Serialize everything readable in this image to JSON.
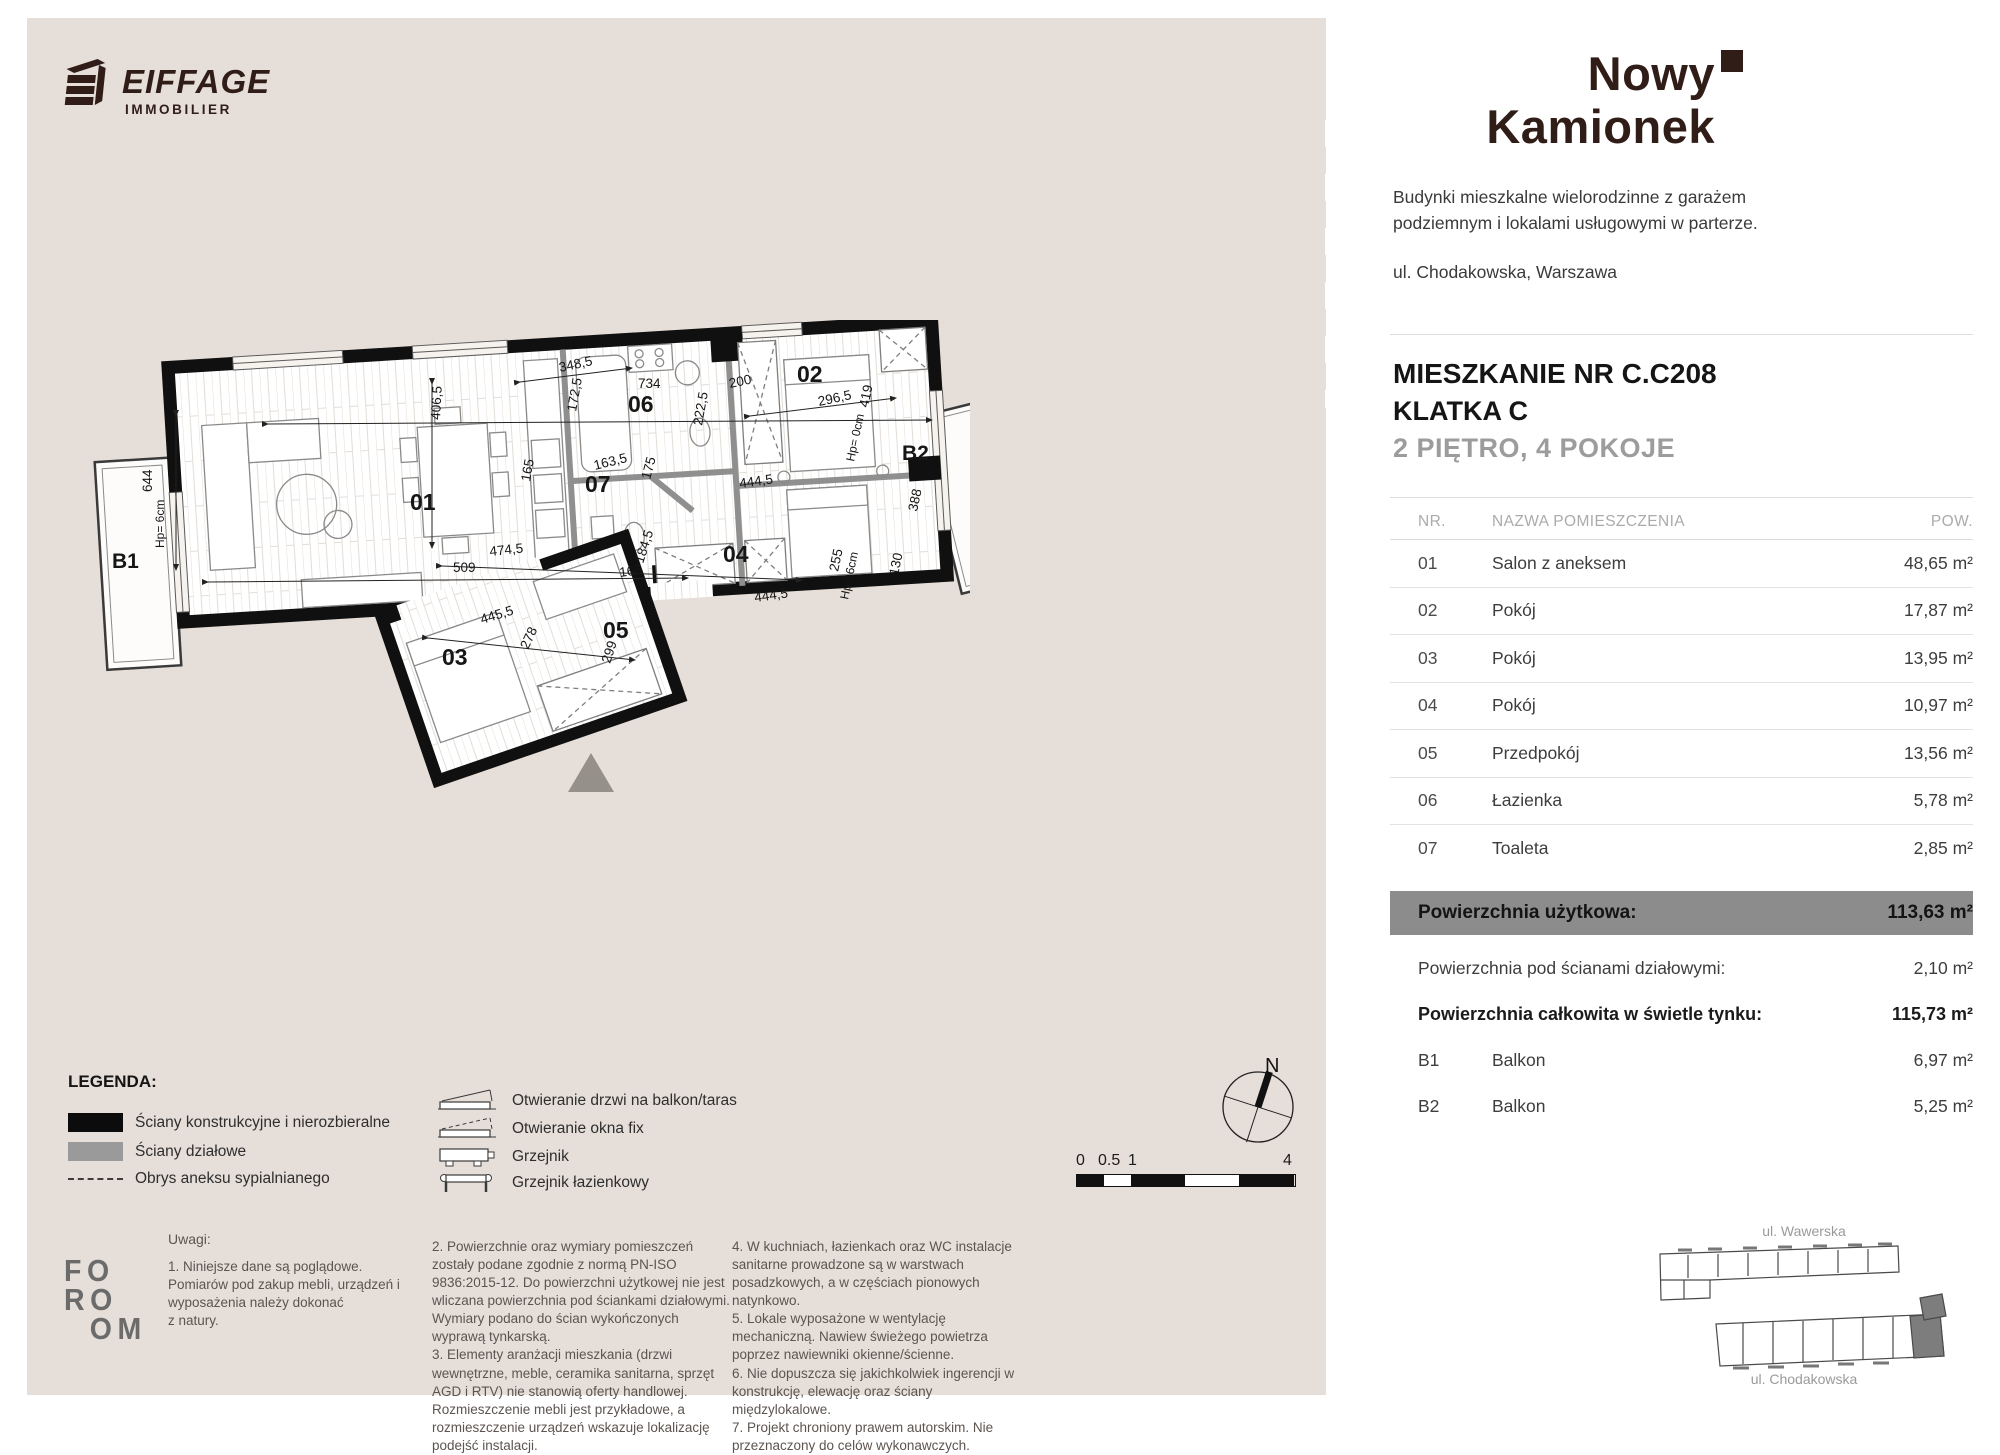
{
  "brand": {
    "logo_text": "EIFFAGE",
    "logo_sub": "IMMOBILIER"
  },
  "project": {
    "title_line1": "Nowy",
    "title_line2": "Kamionek",
    "description": "Budynki mieszkalne wielorodzinne z garażem podziemnym i lokalami usługowymi w parterze.",
    "address": "ul. Chodakowska, Warszawa"
  },
  "apartment": {
    "name": "MIESZKANIE NR C.C208",
    "staircase": "KLATKA C",
    "floor_rooms": "2 PIĘTRO, 4 POKOJE"
  },
  "table": {
    "headers": {
      "nr": "NR.",
      "name": "NAZWA POMIESZCZENIA",
      "area": "POW."
    },
    "rows": [
      {
        "nr": "01",
        "name": "Salon z aneksem",
        "area": "48,65 m²"
      },
      {
        "nr": "02",
        "name": "Pokój",
        "area": "17,87 m²"
      },
      {
        "nr": "03",
        "name": "Pokój",
        "area": "13,95 m²"
      },
      {
        "nr": "04",
        "name": "Pokój",
        "area": "10,97 m²"
      },
      {
        "nr": "05",
        "name": "Przedpokój",
        "area": "13,56 m²"
      },
      {
        "nr": "06",
        "name": "Łazienka",
        "area": "5,78 m²"
      },
      {
        "nr": "07",
        "name": "Toaleta",
        "area": "2,85 m²"
      }
    ],
    "summary_highlight": {
      "label": "Powierzchnia użytkowa:",
      "value": "113,63 m²"
    },
    "summary_rows": [
      {
        "label": "Powierzchnia pod ścianami działowymi:",
        "value": "2,10 m²"
      },
      {
        "label": "Powierzchnia całkowita w świetle tynku:",
        "value": "115,73 m²"
      }
    ],
    "balconies": [
      {
        "nr": "B1",
        "name": "Balkon",
        "area": "6,97 m²"
      },
      {
        "nr": "B2",
        "name": "Balkon",
        "area": "5,25 m²"
      }
    ]
  },
  "legend": {
    "title": "LEGENDA:",
    "items_left": [
      "Ściany konstrukcyjne i nierozbieralne",
      "Ściany działowe",
      "Obrys aneksu sypialnianego"
    ],
    "items_right": [
      "Otwieranie drzwi na balkon/taras",
      "Otwieranie okna fix",
      "Grzejnik",
      "Grzejnik łazienkowy"
    ]
  },
  "notes": {
    "title": "Uwagi:",
    "col1": "1. Niniejsze dane są poglądowe.\n Pomiarów pod zakup mebli, urządzeń i wyposażenia należy dokonać\nz natury.",
    "col2": "2. Powierzchnie oraz wymiary pomieszczeń zostały podane zgodnie z normą PN-ISO 9836:2015-12. Do powierzchni użytkowej nie jest wliczana powierzchnia pod ściankami działowymi. Wymiary podano do ścian wykończonych wyprawą tynkarską.\n3. Elementy aranżacji mieszkania (drzwi wewnętrzne, meble, ceramika sanitarna, sprzęt AGD i RTV) nie stanowią oferty handlowej. Rozmieszczenie mebli jest przykładowe, a rozmieszczenie urządzeń wskazuje lokalizację podejść instalacji.",
    "col3": "4. W kuchniach, łazienkach oraz WC instalacje sanitarne prowadzone są w warstwach posadzkowych, a w częściach pionowych natynkowo.\n5. Lokale wyposażone w wentylację mechaniczną. Nawiew świeżego powietrza poprzez nawiewniki okienne/ścienne.\n6. Nie dopuszcza się jakichkolwiek ingerencji w konstrukcję, elewację oraz ściany międzylokalowe.\n7. Projekt chroniony prawem autorskim. Nie przeznaczony do celów wykonawczych."
  },
  "floor_plan": {
    "north_label": "N",
    "labels": [
      {
        "t": "01",
        "x": 320,
        "y": 190,
        "c": "room"
      },
      {
        "t": "02",
        "x": 707,
        "y": 62,
        "c": "room"
      },
      {
        "t": "03",
        "x": 352,
        "y": 345,
        "c": "room"
      },
      {
        "t": "04",
        "x": 633,
        "y": 242,
        "c": "room"
      },
      {
        "t": "05",
        "x": 513,
        "y": 318,
        "c": "room"
      },
      {
        "t": "06",
        "x": 538,
        "y": 92,
        "c": "room"
      },
      {
        "t": "07",
        "x": 495,
        "y": 172,
        "c": "room"
      },
      {
        "t": "B1",
        "x": 22,
        "y": 248,
        "c": "bal"
      },
      {
        "t": "B2",
        "x": 812,
        "y": 140,
        "c": "bal"
      },
      {
        "t": "734",
        "x": 548,
        "y": 68,
        "c": "dim"
      },
      {
        "t": "348,5",
        "x": 470,
        "y": 52,
        "r": -12,
        "c": "dim"
      },
      {
        "t": "172,5",
        "x": 486,
        "y": 92,
        "r": -80,
        "c": "dim"
      },
      {
        "t": "406,5",
        "x": 350,
        "y": 100,
        "r": -87,
        "c": "dim"
      },
      {
        "t": "200",
        "x": 640,
        "y": 68,
        "r": -12,
        "c": "dim"
      },
      {
        "t": "222,5",
        "x": 612,
        "y": 106,
        "r": -80,
        "c": "dim"
      },
      {
        "t": "296,5",
        "x": 729,
        "y": 86,
        "r": -12,
        "c": "dim"
      },
      {
        "t": "419",
        "x": 778,
        "y": 88,
        "r": -78,
        "c": "dim"
      },
      {
        "t": "644",
        "x": 62,
        "y": 172,
        "r": -90,
        "c": "dim"
      },
      {
        "t": "Hp= 6cm",
        "x": 74,
        "y": 228,
        "r": -90,
        "c": "hp"
      },
      {
        "t": "509",
        "x": 363,
        "y": 252,
        "c": "dim"
      },
      {
        "t": "474,5",
        "x": 400,
        "y": 236,
        "r": -6,
        "c": "dim"
      },
      {
        "t": "165",
        "x": 440,
        "y": 162,
        "r": -80,
        "c": "dim"
      },
      {
        "t": "163,5",
        "x": 505,
        "y": 150,
        "r": -14,
        "c": "dim"
      },
      {
        "t": "175",
        "x": 560,
        "y": 160,
        "r": -75,
        "c": "dim"
      },
      {
        "t": "444,5",
        "x": 650,
        "y": 168,
        "r": -8,
        "c": "dim"
      },
      {
        "t": "184,5",
        "x": 553,
        "y": 244,
        "r": -72,
        "c": "dim"
      },
      {
        "t": "165",
        "x": 530,
        "y": 257,
        "r": -8,
        "c": "dim"
      },
      {
        "t": "444,5",
        "x": 665,
        "y": 282,
        "r": -8,
        "c": "dim"
      },
      {
        "t": "255",
        "x": 748,
        "y": 252,
        "r": -78,
        "c": "dim"
      },
      {
        "t": "Hp= 6cm",
        "x": 758,
        "y": 280,
        "r": -78,
        "c": "hp"
      },
      {
        "t": "130",
        "x": 808,
        "y": 256,
        "r": -78,
        "c": "dim"
      },
      {
        "t": "388",
        "x": 827,
        "y": 192,
        "r": -78,
        "c": "dim"
      },
      {
        "t": "Hp= 0cm",
        "x": 764,
        "y": 142,
        "r": -78,
        "c": "hp"
      },
      {
        "t": "445,5",
        "x": 392,
        "y": 304,
        "r": -17,
        "c": "dim"
      },
      {
        "t": "278",
        "x": 438,
        "y": 330,
        "r": -65,
        "c": "dim"
      },
      {
        "t": "299",
        "x": 520,
        "y": 344,
        "r": -72,
        "c": "dim"
      }
    ]
  },
  "scale_bar": {
    "labels": [
      "0",
      "0.5",
      "1",
      "4"
    ]
  },
  "site_map": {
    "street_top": "ul. Wawerska",
    "street_bottom": "ul. Chodakowska"
  },
  "foroom": {
    "rows": [
      "FO",
      "RO",
      "OM"
    ]
  }
}
